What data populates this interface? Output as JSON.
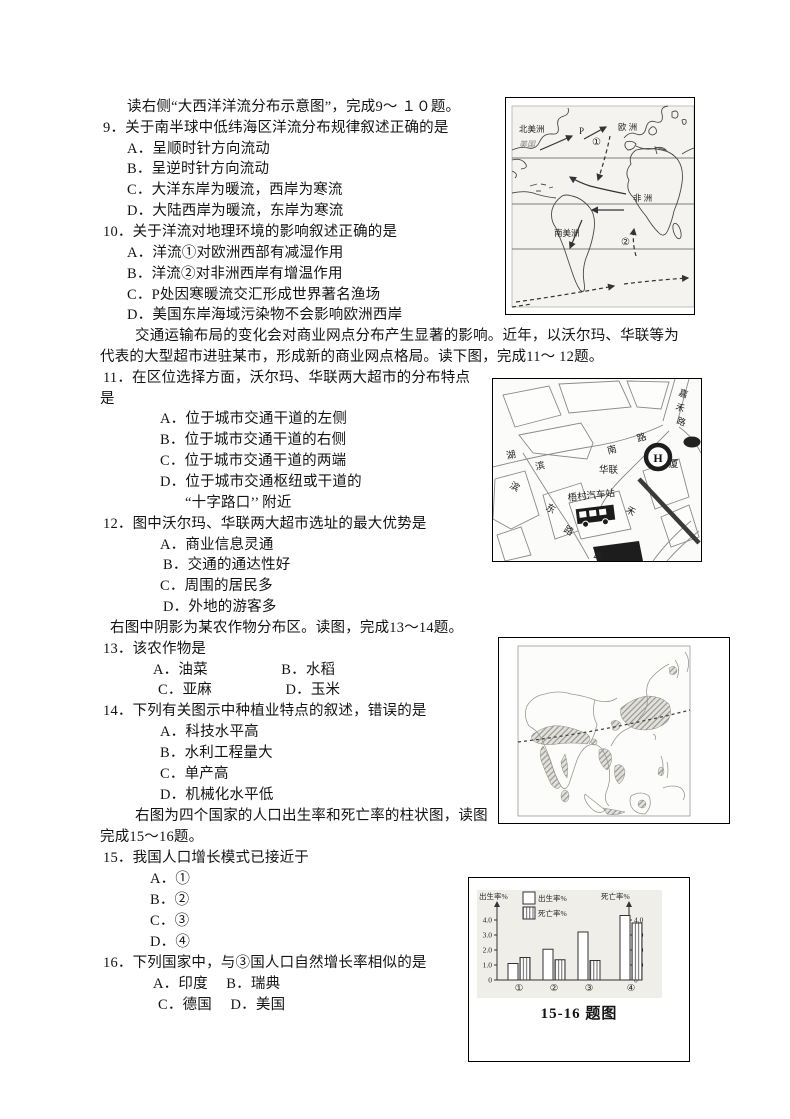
{
  "doc": {
    "lines": [
      "读右侧“大西洋洋流分布示意图”，完成9～ １０题。",
      "9．关于南半球中低纬海区洋流分布规律叙述正确的是",
      "A．呈顺时针方向流动",
      "B．呈逆时针方向流动",
      "C．大洋东岸为暖流，西岸为寒流",
      "D．大陆西岸为暖流，东岸为寒流",
      "10．关于洋流对地理环境的影响叙述正确的是",
      "A．洋流①对欧洲西部有减湿作用",
      "B．洋流②对非洲西岸有增温作用",
      "C．P处因寒暖流交汇形成世界著名渔场",
      "D．美国东岸海域污染物不会影响欧洲西岸",
      "交通运输布局的变化会对商业网点分布产生显著的影响。近年，以沃尔玛、华联等为",
      "代表的大型超市进驻某市，形成新的商业网点格局。读下图，完成11～ 12题。",
      "11．在区位选择方面，沃尔玛、华联两大超市的分布特点",
      "是",
      "A．位于城市交通干道的左侧",
      "B．位于城市交通干道的右侧",
      "C．位于城市交通干道的两端",
      "D．位于城市交通枢纽或干道的",
      "“十字路口’’ 附近",
      "12．图中沃尔玛、华联两大超市选址的最大优势是",
      "A．商业信息灵通",
      "B．交通的通达性好",
      "C．周围的居民多",
      "D．外地的游客多",
      "右图中阴影为某农作物分布区。读图，完成13～14题。",
      "13．该农作物是",
      "A．油菜　　　　　B．水稻",
      "C．亚麻　　　　　D．玉米",
      "14．下列有关图示中种植业特点的叙述，错误的是",
      "A．科技水平高",
      "B．水利工程量大",
      "C．单产高",
      "D．机械化水平低",
      "右图为四个国家的人口出生率和死亡率的柱状图，读图",
      "完成15～16题。",
      "15．我国人口增长模式已接近于",
      "A．①",
      "B．②",
      "C．③",
      "D．④",
      "16．下列国家中，与③国人口自然增长率相似的是",
      "A．印度　 B．瑞典",
      "C．德国　 D．美国"
    ]
  },
  "figures": {
    "atlantic": {
      "labels": {
        "north_america": "北美洲",
        "usa": "美国",
        "europe": "欧  洲",
        "africa": "非  洲",
        "south_america": "南美洲",
        "p": "P",
        "current1": "①",
        "current2": "②"
      }
    },
    "citymap": {
      "labels": {
        "hu": "湖",
        "bin": "滨",
        "nan": "南",
        "lu": "路",
        "bin2": "滨",
        "dong": "东",
        "lu2": "路",
        "lu3": "路",
        "hualian": "华联",
        "h_logo": "H",
        "xia": "厦",
        "jia": "嘉",
        "he": "禾",
        "lu4": "路",
        "he2": "禾",
        "bus_station": "梧村汽车站"
      }
    }
  },
  "chart_data": {
    "type": "bar",
    "title": "四个国家的人口出生率和死亡率柱状图",
    "categories": [
      "①",
      "②",
      "③",
      "④"
    ],
    "series": [
      {
        "name": "出生率%",
        "values": [
          1.1,
          2.05,
          3.2,
          4.3
        ],
        "style": "open"
      },
      {
        "name": "死亡率%",
        "values": [
          1.5,
          1.35,
          1.3,
          3.8
        ],
        "style": "hatched"
      }
    ],
    "left_axis_label": "出生率%",
    "right_axis_label": "死亡率%",
    "ticks": [
      0,
      1.0,
      2.0,
      3.0,
      4.0
    ],
    "ylim": [
      0,
      4.6
    ],
    "legend_position": "top",
    "grid": false,
    "caption": "15-16 题图"
  },
  "colors": {
    "text": "#141414",
    "figure_border": "#000000",
    "scan_grey": "#f4f3f0",
    "chart_panel": "#efeee9"
  }
}
